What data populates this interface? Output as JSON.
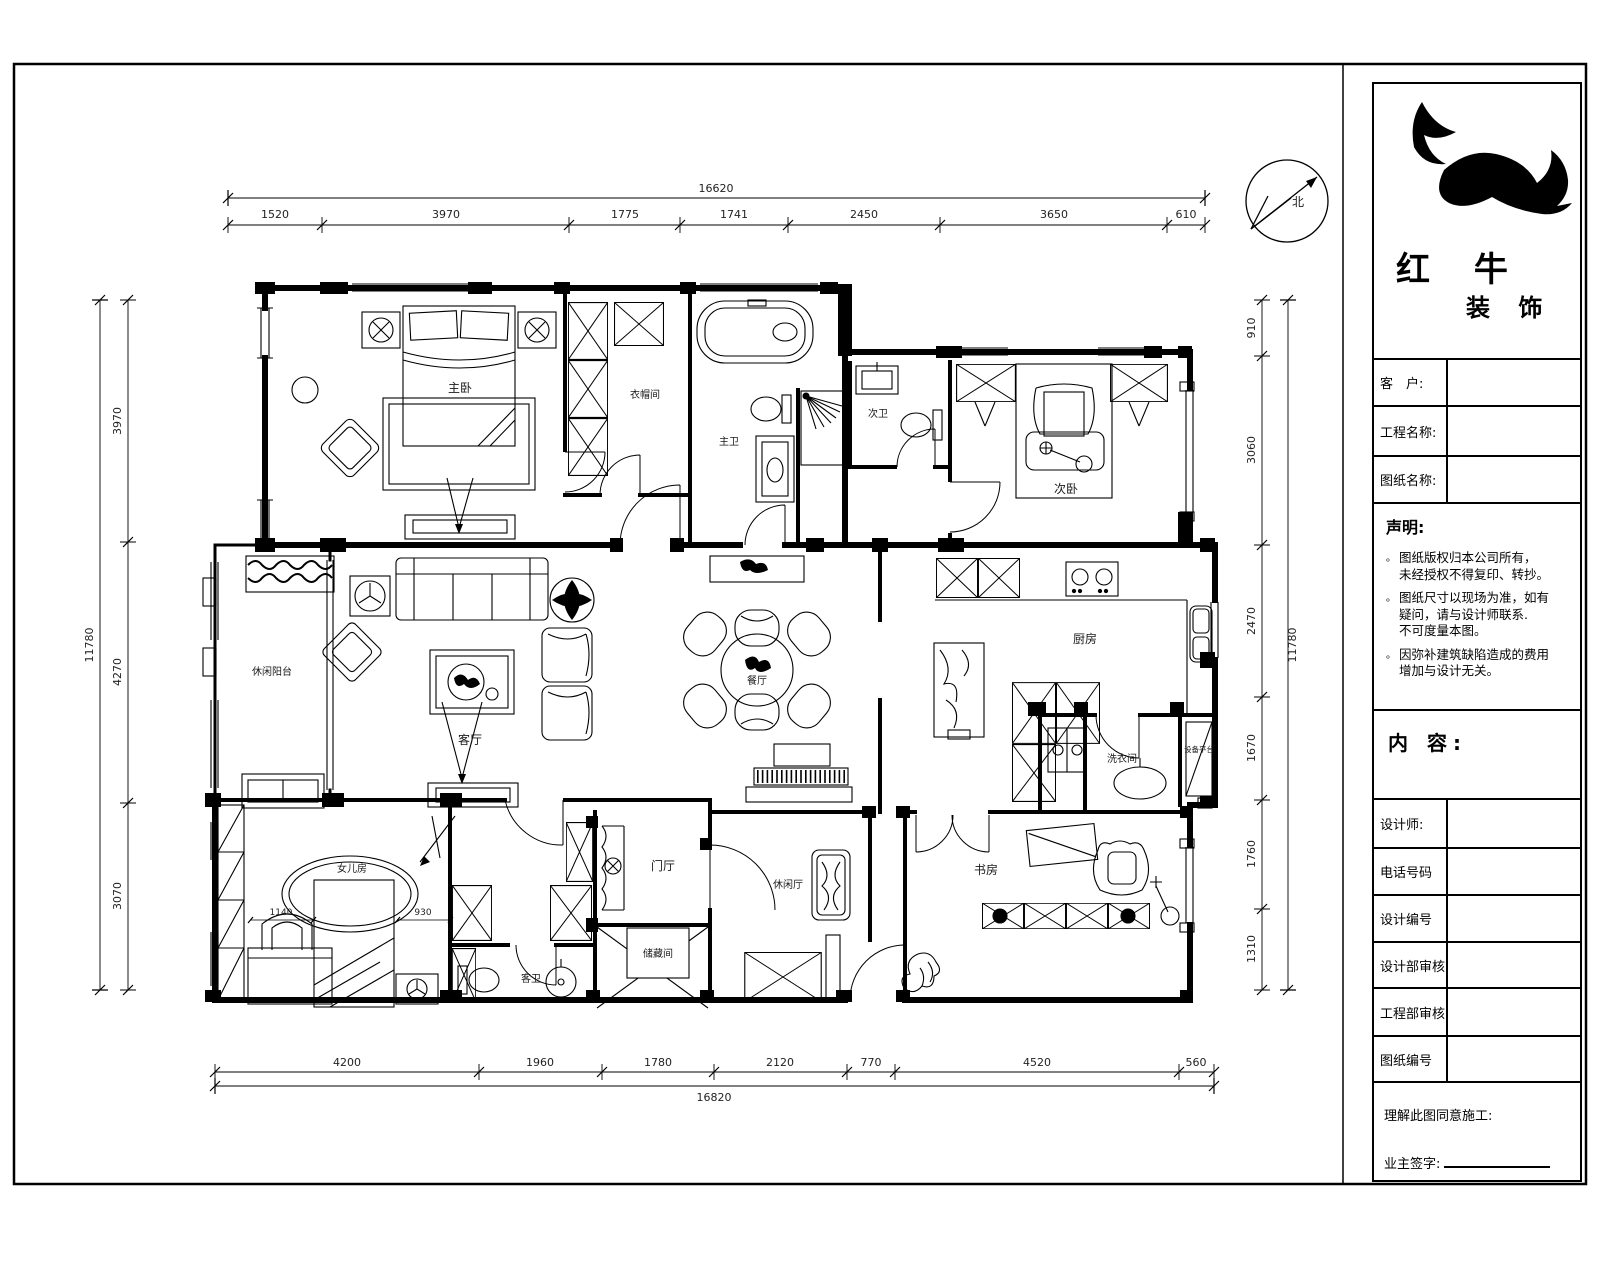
{
  "north_label": "北",
  "brand": {
    "line1": "红 牛",
    "line2": "装 饰"
  },
  "title_block": {
    "fields": [
      {
        "label": "客　户:"
      },
      {
        "label": "工程名称:"
      },
      {
        "label": "图纸名称:"
      }
    ],
    "statement": {
      "title": "声明:",
      "marker": "。",
      "items": [
        "图纸版权归本公司所有，\n未经授权不得复印、转抄。",
        "图纸尺寸以现场为准，如有\n疑问，请与设计师联系.\n不可度量本图。",
        "因弥补建筑缺陷造成的费用\n增加与设计无关。"
      ]
    },
    "content_label": "内 容:",
    "rows": [
      {
        "label": "设计师:"
      },
      {
        "label": "电话号码"
      },
      {
        "label": "设计编号"
      },
      {
        "label": "设计部审核:"
      },
      {
        "label": "工程部审核:"
      },
      {
        "label": "图纸编号"
      }
    ],
    "footer": {
      "line1": "理解此图同意施工:",
      "line2": "业主签字:"
    }
  },
  "rooms": {
    "master_bedroom": "主卧",
    "closet_top": "衣帽间",
    "master_bath": "主卫",
    "second_bath": "次卫",
    "second_bedroom": "次卧",
    "leisure_balcony": "休闲阳台",
    "living_room": "客厅",
    "dining_room": "餐厅",
    "kitchen": "厨房",
    "laundry": "洗衣间",
    "equipment_platform": "设备平台",
    "daughter_room": "女儿房",
    "guest_bath": "客卫",
    "foyer": "门厅",
    "storage": "储藏间",
    "leisure_room": "休闲厅",
    "study": "书房"
  },
  "dimensions": {
    "top": {
      "total": "16620",
      "segments": [
        "1520",
        "3970",
        "1775",
        "1741",
        "2450",
        "3650",
        "610"
      ]
    },
    "bottom": {
      "total": "16820",
      "segments": [
        "4200",
        "1960",
        "1780",
        "2120",
        "770",
        "4520",
        "560"
      ]
    },
    "left": {
      "total": "11780",
      "segments": [
        "3970",
        "4270",
        "3070"
      ]
    },
    "right": {
      "total": "11780",
      "segments": [
        "910",
        "3060",
        "2470",
        "1670",
        "1760",
        "1310"
      ]
    },
    "inner": {
      "d1": "1140",
      "d2": "930"
    }
  }
}
